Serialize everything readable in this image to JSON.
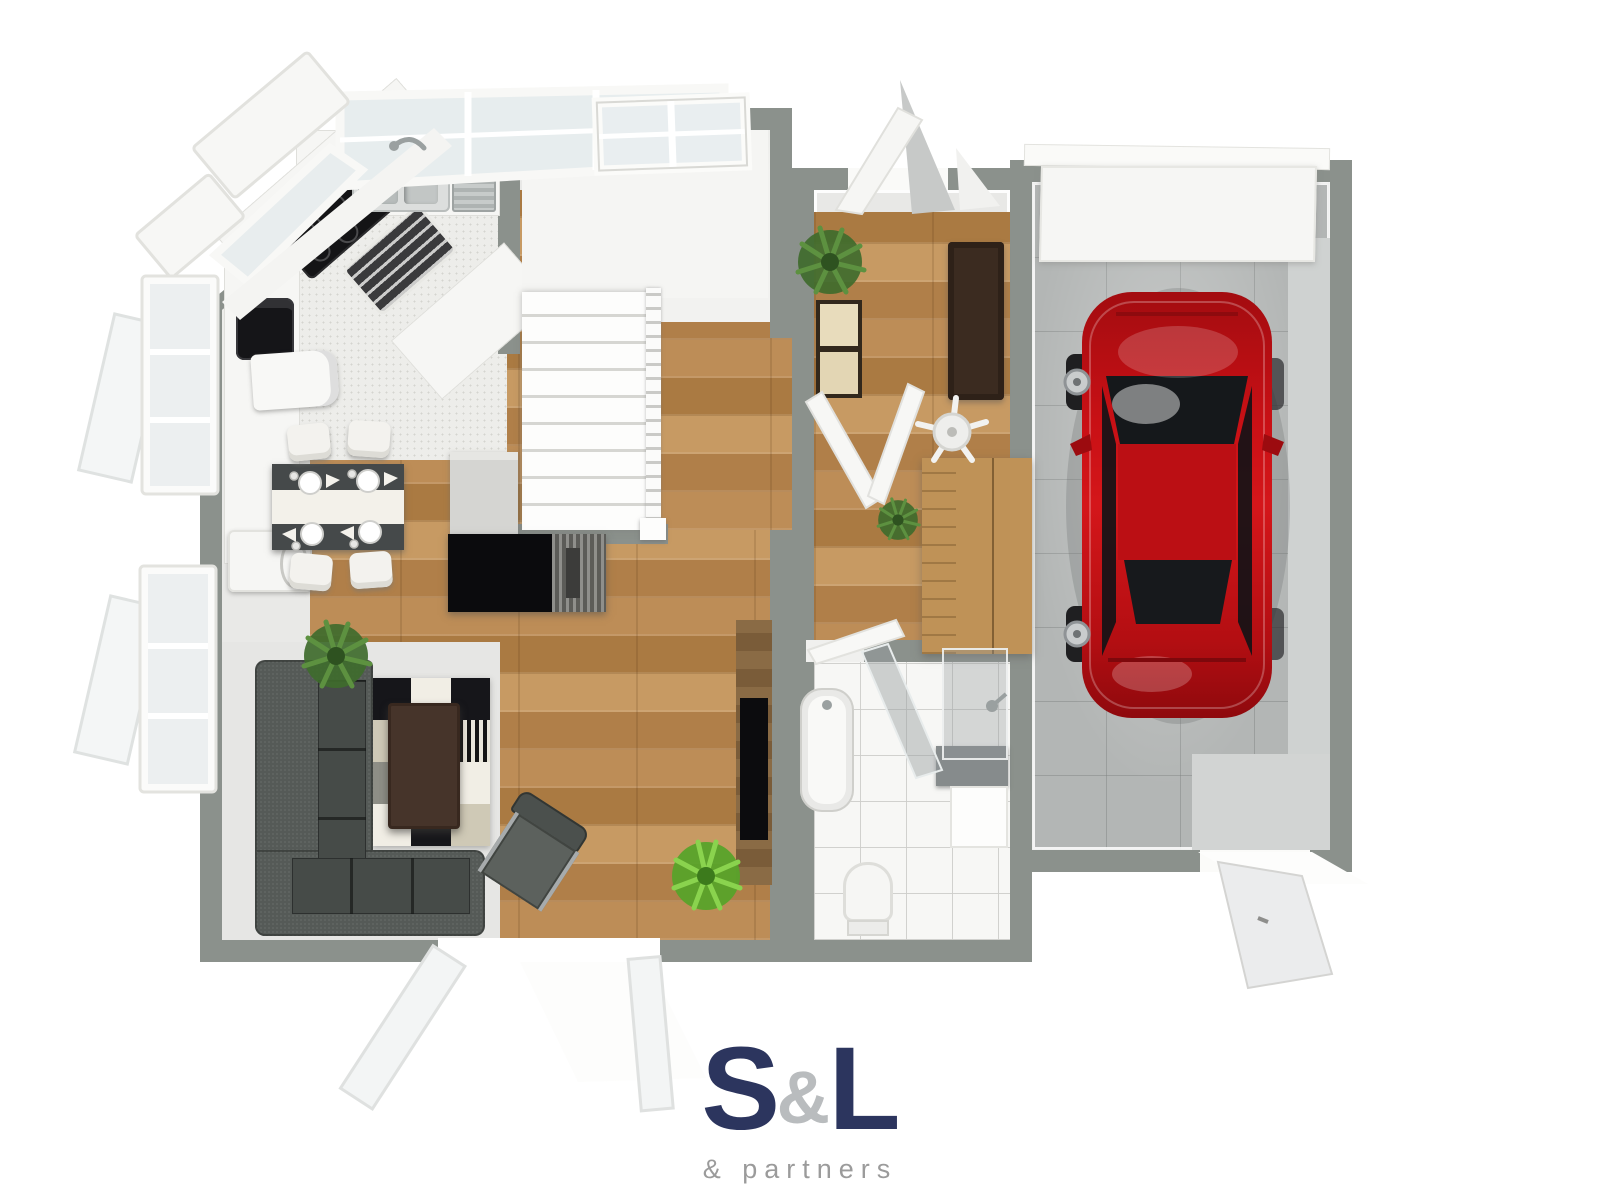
{
  "logo": {
    "letter_s": "S",
    "ampersand": "&",
    "letter_l": "L",
    "tagline": "& partners"
  },
  "palette": {
    "navy": "#2c355e",
    "silver": "#b9bcbe",
    "taggray": "#9b9b9b",
    "wall": "#8b918c",
    "floorgray": "#e8e8e6",
    "wood1": "#bd8d57",
    "wood2": "#b07f49",
    "wood3": "#c79a63",
    "wood4": "#aa7a42",
    "concrete": "#b3b6b5",
    "tile": "#f7f7f5",
    "sofa": "#555a57",
    "carred": "#c81015"
  }
}
